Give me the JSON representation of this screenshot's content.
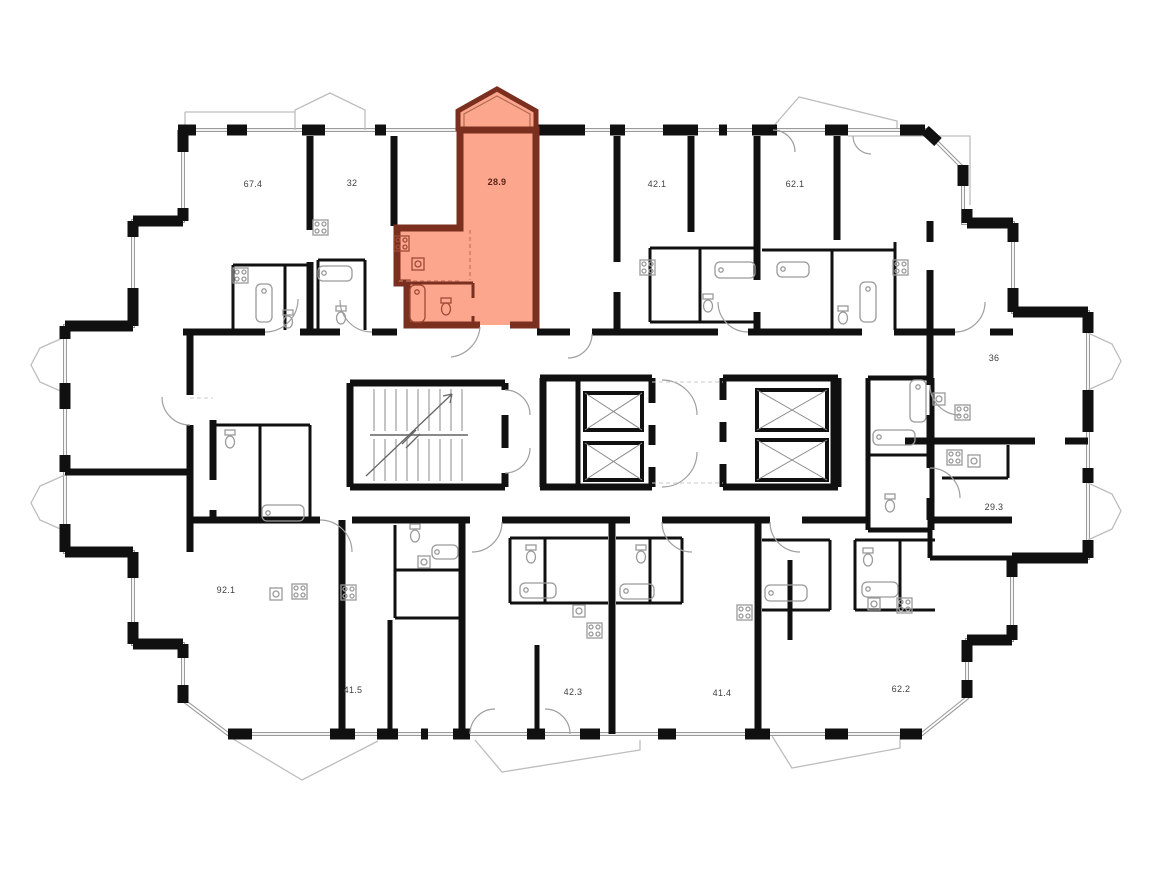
{
  "plan": {
    "type": "residential-floor-plan",
    "units": [
      {
        "area": "67.4",
        "selected": false
      },
      {
        "area": "32",
        "selected": false
      },
      {
        "area": "28.9",
        "selected": true
      },
      {
        "area": "42.1",
        "selected": false
      },
      {
        "area": "62.1",
        "selected": false
      },
      {
        "area": "36",
        "selected": false
      },
      {
        "area": "29.3",
        "selected": false
      },
      {
        "area": "92.1",
        "selected": false
      },
      {
        "area": "41.5",
        "selected": false
      },
      {
        "area": "42.3",
        "selected": false
      },
      {
        "area": "41.4",
        "selected": false
      },
      {
        "area": "62.2",
        "selected": false
      }
    ],
    "selected_unit": {
      "area": "28.9",
      "fill": "#FBA68D",
      "wall_color": "#7A2F1F"
    },
    "core": {
      "staircases": 1,
      "elevators": 4
    },
    "colors": {
      "wall": "#101010",
      "window_line": "#9B9B9B",
      "balcony_line": "#BDBDBD",
      "fixture_line": "#9A9A9A",
      "background": "#FFFFFF"
    }
  }
}
